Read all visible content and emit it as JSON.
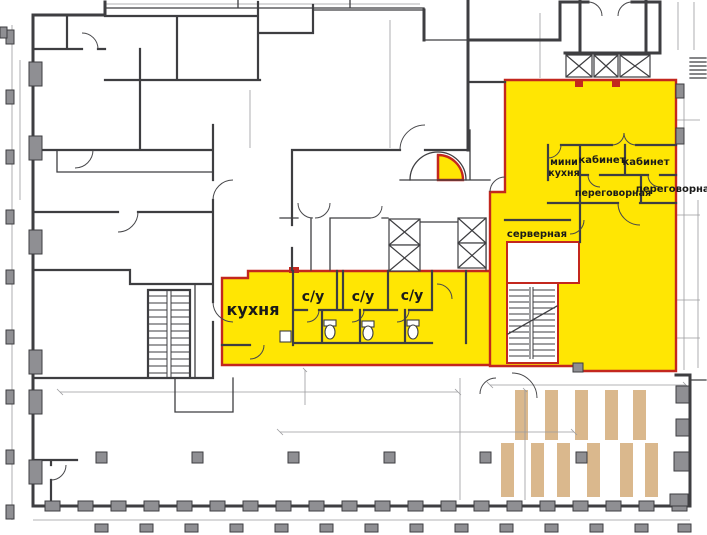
{
  "plan": {
    "labels": {
      "kitchen": "кухня",
      "wc_1": "с/у",
      "wc_2": "с/у",
      "wc_3": "с/у",
      "mini_kitchen_line_1": "мини",
      "mini_kitchen_line_2": "кухня",
      "office_1": "кабинет",
      "office_2": "кабинет",
      "meeting_1": "переговорная",
      "meeting_2": "переговорная",
      "server_room": "серверная"
    },
    "colors": {
      "highlight_yellow": "#FFE603",
      "lease_boundary_red": "#C3271E",
      "wall_dark": "#3E3E41",
      "column_gray": "#8F8F93",
      "parking_tan": "#DAB88D",
      "dimension_gray": "#9B9B9E",
      "label_text": "#1A1A1A",
      "background": "#FFFFFF"
    }
  }
}
